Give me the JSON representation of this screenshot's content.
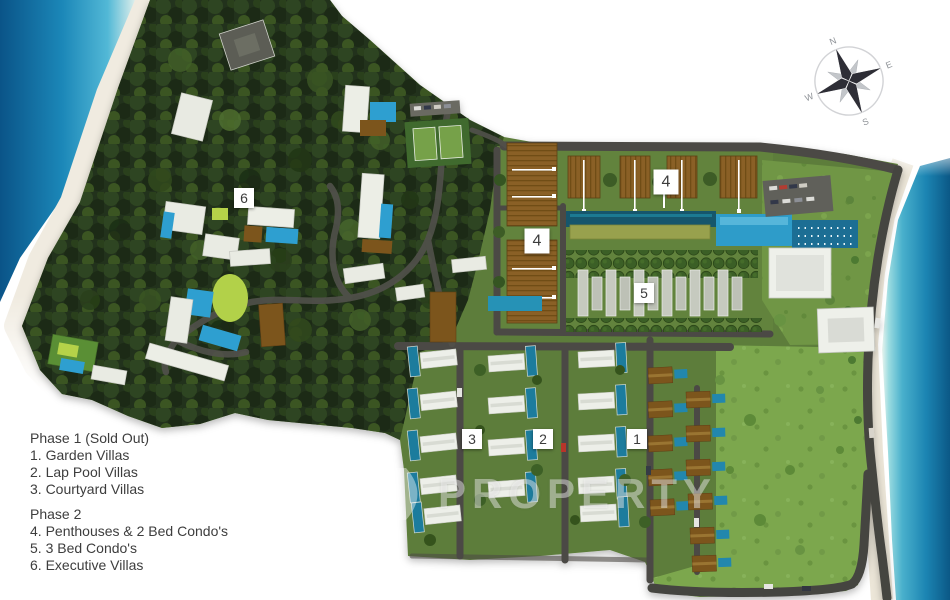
{
  "title": "Resort development master plan",
  "legend": {
    "phase1": {
      "title": "Phase 1 (Sold Out)",
      "items": [
        "1. Garden Villas",
        "2. Lap Pool Villas",
        "3. Courtyard Villas"
      ]
    },
    "phase2": {
      "title": "Phase 2",
      "items": [
        "4. Penthouses & 2 Bed Condo's",
        "5. 3 Bed Condo's",
        "6. Executive Villas"
      ]
    }
  },
  "markers": [
    {
      "label": "6"
    },
    {
      "label": "4"
    },
    {
      "label": "4"
    },
    {
      "label": "5"
    },
    {
      "label": "3"
    },
    {
      "label": "2"
    },
    {
      "label": "1"
    }
  ],
  "compass": {
    "north": "N",
    "east": "E",
    "south": "S",
    "west": "W"
  },
  "watermark": {
    "logo": "chevron-d-logo",
    "text": "PROPERTY"
  },
  "colors": {
    "water_deep": "#0b5886",
    "water_light": "#52b8d6",
    "sand": "#f0ebdf",
    "forest": "#24331a",
    "lawn": "#7ca74e",
    "road": "#4b4a45",
    "roof_brown": "#8a6126",
    "roof_white": "#edefe9",
    "pool_teal": "#1f7c9d",
    "pool_bright": "#2f9fd0",
    "lime_lawn": "#b5d24a"
  }
}
